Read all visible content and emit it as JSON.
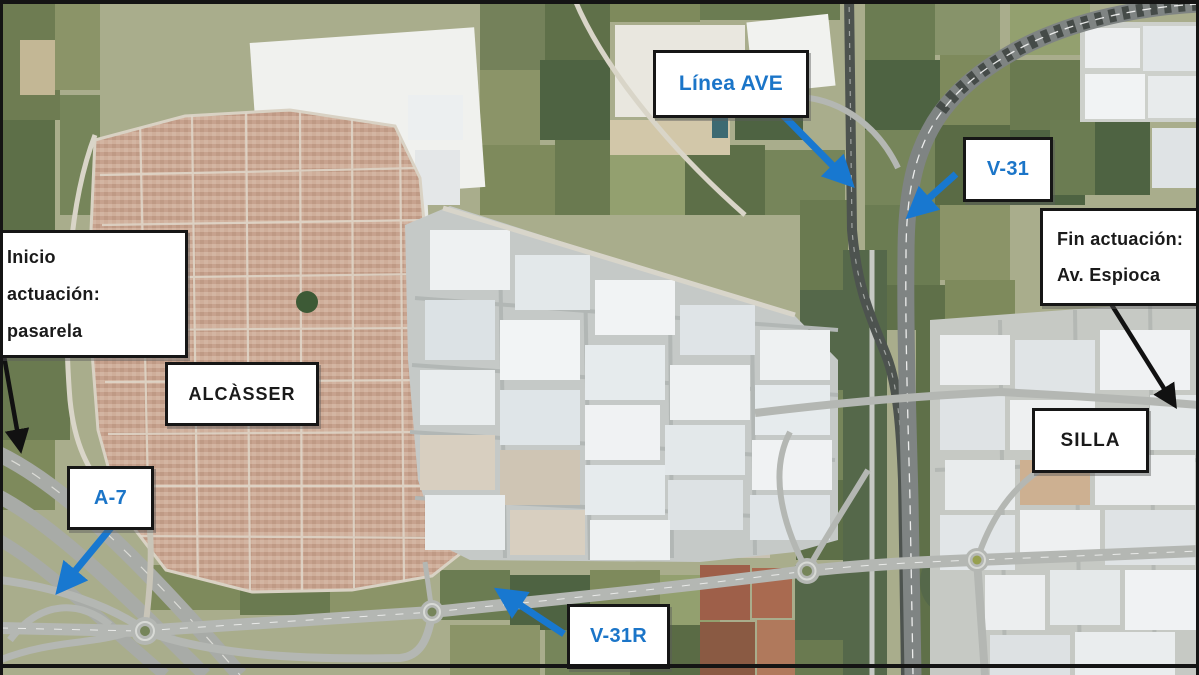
{
  "figure": {
    "kind": "aerial-satellite-map",
    "description": "Aerial photo of Alcàsser and Silla with road/rail callouts"
  },
  "callouts": {
    "linea_ave": {
      "label": "Línea AVE"
    },
    "v31": {
      "label": "V-31"
    },
    "fin_actuacion": {
      "line1": "Fin actuación:",
      "line2": "Av. Espioca"
    },
    "inicio_actuacion": {
      "line1": "Inicio",
      "line2": "actuación:",
      "line3": "pasarela"
    },
    "alcasser": {
      "label": "ALCÀSSER"
    },
    "a7": {
      "label": "A-7"
    },
    "silla": {
      "label": "SILLA"
    },
    "v31r": {
      "label": "V-31R"
    }
  },
  "colors": {
    "label_blue": "#1b75c8",
    "label_black": "#1a1a1a",
    "arrow_blue": "#1878d0",
    "arrow_black": "#111111",
    "box_border": "#161616",
    "box_background": "#ffffff"
  }
}
